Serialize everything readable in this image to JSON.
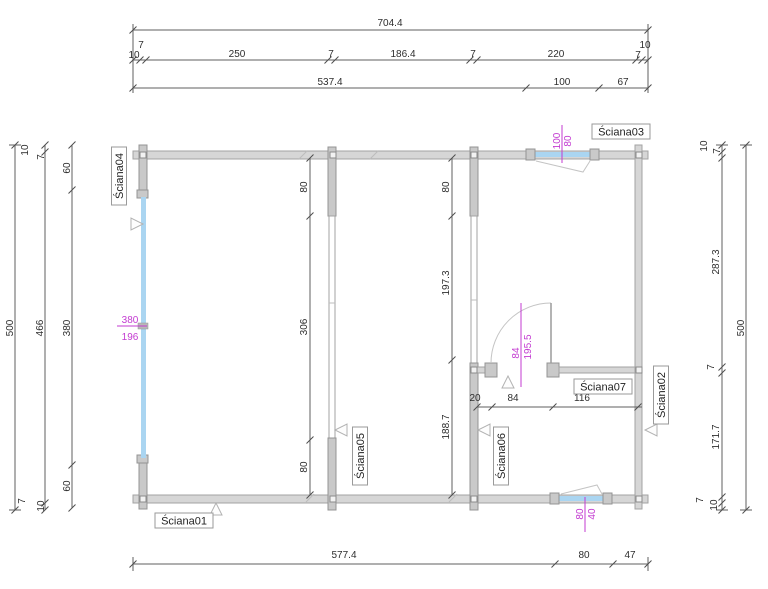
{
  "title": "Floor plan drawing",
  "colors": {
    "magenta": "#c33bd1",
    "glazing": "#aad5f1",
    "wall_fill": "#d6d6d6",
    "wall_post": "#c9c9c9",
    "dim_line": "#5f5f5f",
    "label_border": "#9a9a9a"
  },
  "wall_labels": {
    "s01": "Ściana01",
    "s02": "Ściana02",
    "s03": "Ściana03",
    "s04": "Ściana04",
    "s05": "Ściana05",
    "s06": "Ściana06",
    "s07": "Ściana07"
  },
  "dims": {
    "top_total": "704.4",
    "top_row2": {
      "l7": "7",
      "l10": "10",
      "seg1": "250",
      "seg2": "7",
      "seg3": "186.4",
      "seg4": "7",
      "seg5": "220",
      "r10": "10",
      "r7": "7"
    },
    "top_row3": {
      "seg1": "537.4",
      "seg2": "100",
      "seg3": "67"
    },
    "bottom_row": {
      "seg1": "577.4",
      "seg2": "80",
      "seg3": "47"
    },
    "left": {
      "outer": "500",
      "middle": "466",
      "top10": "10",
      "top7": "7",
      "seg_top": "60",
      "seg_mid": "380",
      "seg_bottom": "60",
      "bottom7": "7",
      "bottom10": "10"
    },
    "right": {
      "outer": "500",
      "top10": "10",
      "top7": "7",
      "upper": "287.3",
      "mid7": "7",
      "lower": "171.7",
      "bottom7": "7",
      "bottom10": "10"
    },
    "wall5": {
      "top": "80",
      "mid": "306",
      "bottom": "80"
    },
    "wall6": {
      "top": "80",
      "mid": "197.3",
      "bottom": "188.7"
    },
    "wall7": {
      "seg1": "20",
      "seg2": "84",
      "seg3": "116"
    }
  },
  "annotations": {
    "window_left": {
      "a": "380",
      "b": "196"
    },
    "window_top": {
      "a": "100",
      "b": "80"
    },
    "window_bottom": {
      "a": "80",
      "b": "40"
    },
    "door": {
      "a": "84",
      "b": "195.5"
    }
  }
}
